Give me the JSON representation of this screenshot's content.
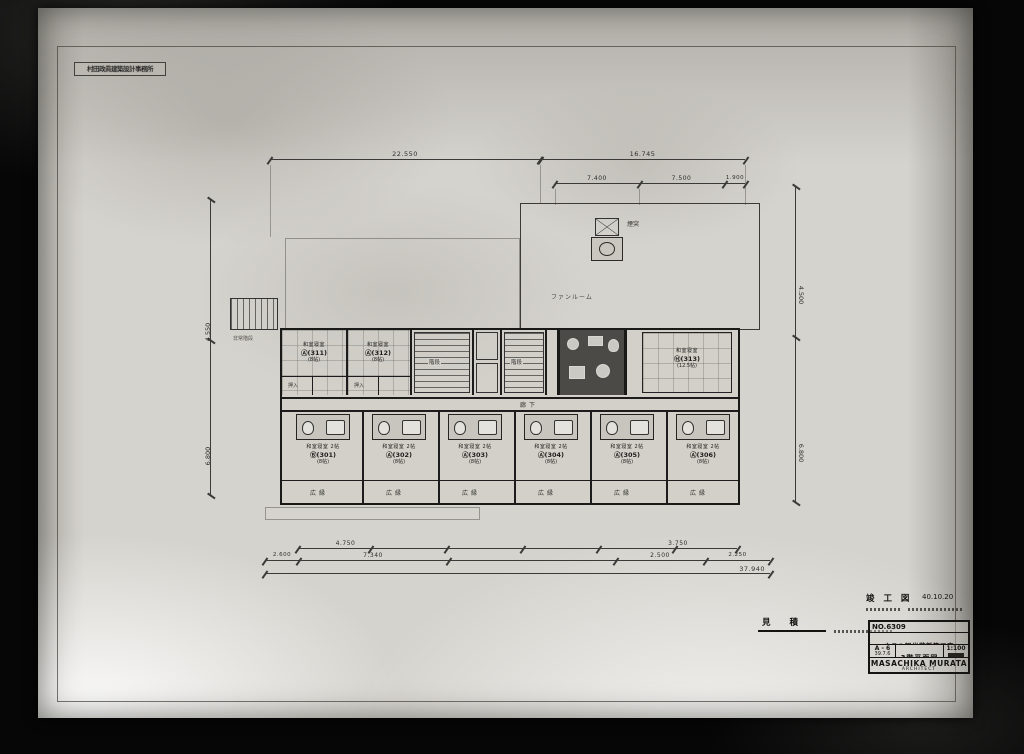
{
  "sheet": {
    "office_stamp": "村田政眞建築設計事務所",
    "estimate_label": "見 積",
    "completion_label": "竣 工 図",
    "completion_date": "40.10.20"
  },
  "title_block": {
    "number": "NO.6309",
    "project": "ホテル観光荘新築工事",
    "sheet_no": "A - 6",
    "date": "39.7.6",
    "drawing_title": "3階平面図",
    "scale": "1:100",
    "architect": "MASACHIKA MURATA",
    "architect_title": "ARCHITECT"
  },
  "dims": {
    "top_left_total": "22.550",
    "top_right_total": "16.745",
    "top_sub": [
      "7.400",
      "7.500",
      "1.900"
    ],
    "bottom_row1": [
      "4.750",
      "3.750"
    ],
    "bottom_row2": [
      "2.600",
      "7.340",
      "2.500",
      "2.250"
    ],
    "bottom_total": "37.940",
    "left": [
      "4.550",
      "6.800"
    ],
    "right": [
      "4.500",
      "6.800"
    ]
  },
  "plan": {
    "corridor_label": "廊下",
    "stair_label": "階段",
    "fan_room_label": "ファンルーム",
    "chimney_label": "煙突",
    "fire_stair_label": "非常階段",
    "closet_label": "押入",
    "upper_rooms": [
      {
        "name": "和室寝室",
        "no": "Ⓐ(311)",
        "size": "(8帖)"
      },
      {
        "name": "和室寝室",
        "no": "Ⓐ(312)",
        "size": "(8帖)"
      }
    ],
    "suite": {
      "name": "和室寝室",
      "no": "Ⓗ(313)",
      "size": "(12.5帖)"
    },
    "lower_rooms": [
      {
        "name": "和室寝室 2帖",
        "no": "Ⓑ(301)",
        "size": "(8帖)",
        "veranda": "広縁"
      },
      {
        "name": "和室寝室 2帖",
        "no": "Ⓐ(302)",
        "size": "(8帖)",
        "veranda": "広縁"
      },
      {
        "name": "和室寝室 2帖",
        "no": "Ⓐ(303)",
        "size": "(8帖)",
        "veranda": "広縁"
      },
      {
        "name": "和室寝室 2帖",
        "no": "Ⓐ(304)",
        "size": "(8帖)",
        "veranda": "広縁"
      },
      {
        "name": "和室寝室 2帖",
        "no": "Ⓐ(305)",
        "size": "(8帖)",
        "veranda": "広縁"
      },
      {
        "name": "和室寝室 2帖",
        "no": "Ⓐ(306)",
        "size": "(8帖)",
        "veranda": "広縁"
      }
    ]
  }
}
